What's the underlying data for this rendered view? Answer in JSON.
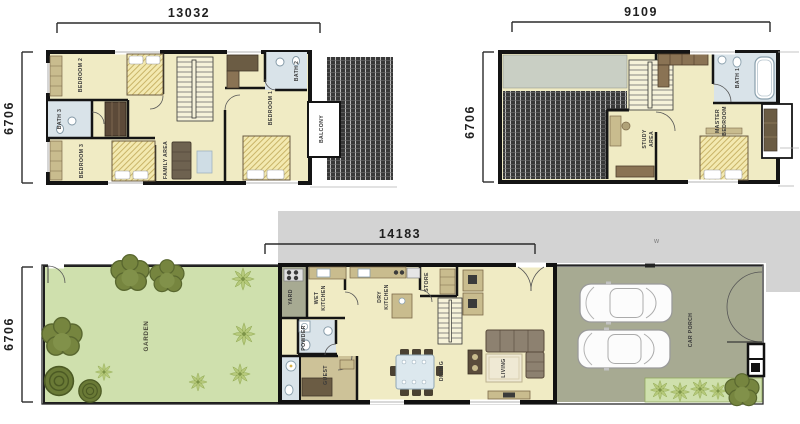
{
  "palette": {
    "wall": "#141414",
    "floor": "#f0ebc4",
    "bath_floor": "#d9e3e9",
    "garden_green": "#cfe0ad",
    "porch_grey_green": "#a7aa92",
    "roof_dark": "#383838",
    "tree_olive": "#76853f",
    "palm_green": "#b7ca7c",
    "furniture_tan": "#c9bc8e",
    "furniture_dark": "#6b5c44",
    "overlay_grey": "#d3d3d3"
  },
  "first_floor": {
    "width_label": "13032",
    "height_label": "6706",
    "rooms": {
      "bedroom2": "BEDROOM 2",
      "bath3": "BATH 3",
      "bedroom3": "BEDROOM 3",
      "family_area": "FAMILY AREA",
      "bedroom1": "BEDROOM 1",
      "bath2": "BATH 2",
      "balcony": "BALCONY"
    }
  },
  "second_floor": {
    "width_label": "9109",
    "height_label": "6706",
    "rooms": {
      "study_area_line1": "STUDY",
      "study_area_line2": "AREA",
      "master_bedroom_line1": "MASTER",
      "master_bedroom_line2": "BEDROOM",
      "bath1": "BATH 1"
    }
  },
  "ground_floor": {
    "width_label": "14183",
    "height_label": "6706",
    "rooms": {
      "garden": "GARDEN",
      "yard": "YARD",
      "wet_kitchen_line1": "WET",
      "wet_kitchen_line2": "KITCHEN",
      "powder": "POWDER",
      "guest": "GUEST",
      "dry_kitchen_line1": "DRY",
      "dry_kitchen_line2": "KITCHEN",
      "store": "STORE",
      "dining": "DINING",
      "living": "LIVING",
      "car_porch": "CAR PORCH"
    }
  },
  "watermark": "w"
}
